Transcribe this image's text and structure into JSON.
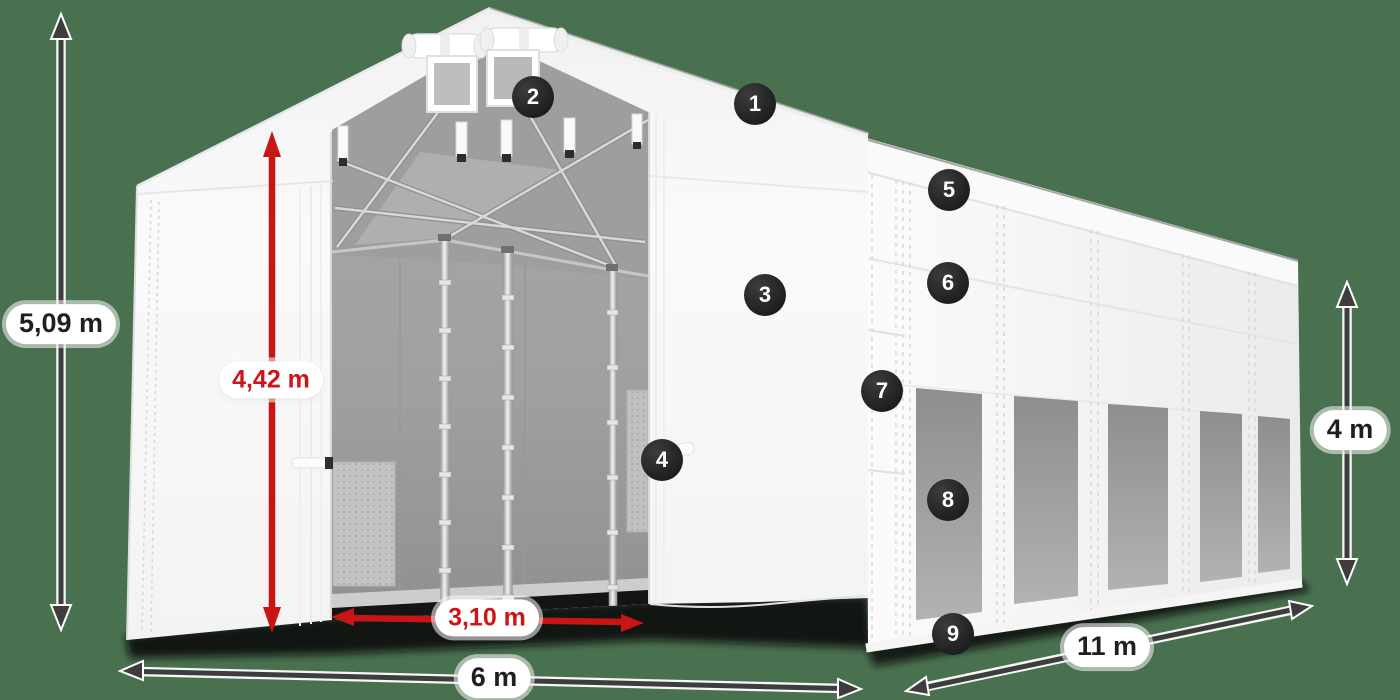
{
  "scene": {
    "description_colors": {
      "background_green": "#49714f",
      "tent_white": "#f7f7f7",
      "window_gray": "#9a9a9a",
      "dimension_arrow_dark": "#3d3d3d",
      "dimension_arrow_red": "#c81515",
      "badge_background": "#262626",
      "badge_text": "#ffffff"
    }
  },
  "badges": [
    {
      "number": "1"
    },
    {
      "number": "2"
    },
    {
      "number": "3"
    },
    {
      "number": "4"
    },
    {
      "number": "5"
    },
    {
      "number": "6"
    },
    {
      "number": "7"
    },
    {
      "number": "8"
    },
    {
      "number": "9"
    }
  ],
  "dimensions": {
    "total_height": {
      "label": "5,09 m"
    },
    "entrance_height": {
      "label": "4,42 m"
    },
    "entrance_width": {
      "label": "3,10 m"
    },
    "front_width": {
      "label": "6 m"
    },
    "side_length": {
      "label": "11 m"
    },
    "side_height": {
      "label": "4 m"
    }
  }
}
